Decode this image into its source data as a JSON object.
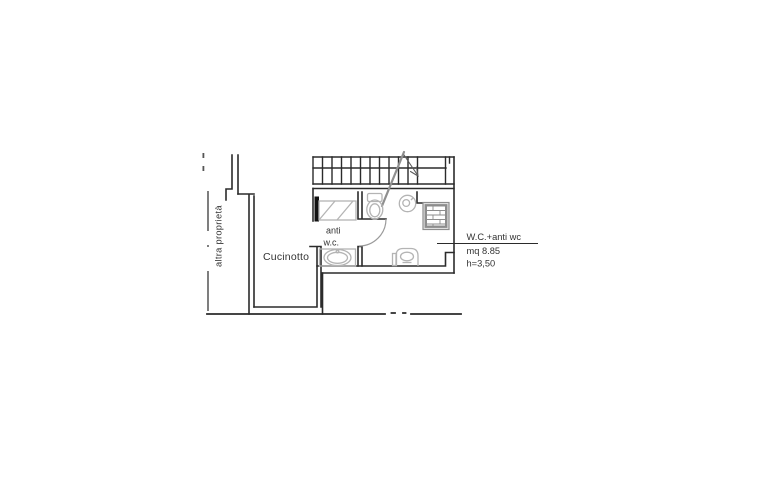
{
  "labels": {
    "other_property": "altra proprietà",
    "kitchenette": "Cucinotto",
    "anti_wc_line1": "anti",
    "anti_wc_line2": "w.c.",
    "annotation_title": "W.C.+anti wc",
    "annotation_area": "mq 8.85",
    "annotation_height": "h=3,50"
  },
  "colors": {
    "background": "#ffffff",
    "wall": "#2b2b2b",
    "fixture": "#b4b4b4",
    "shower_hatch": "#8d8d8d",
    "stair_direction": "#8f8f8f",
    "boundary_dash": "#3a3a3a",
    "text": "#333333"
  }
}
